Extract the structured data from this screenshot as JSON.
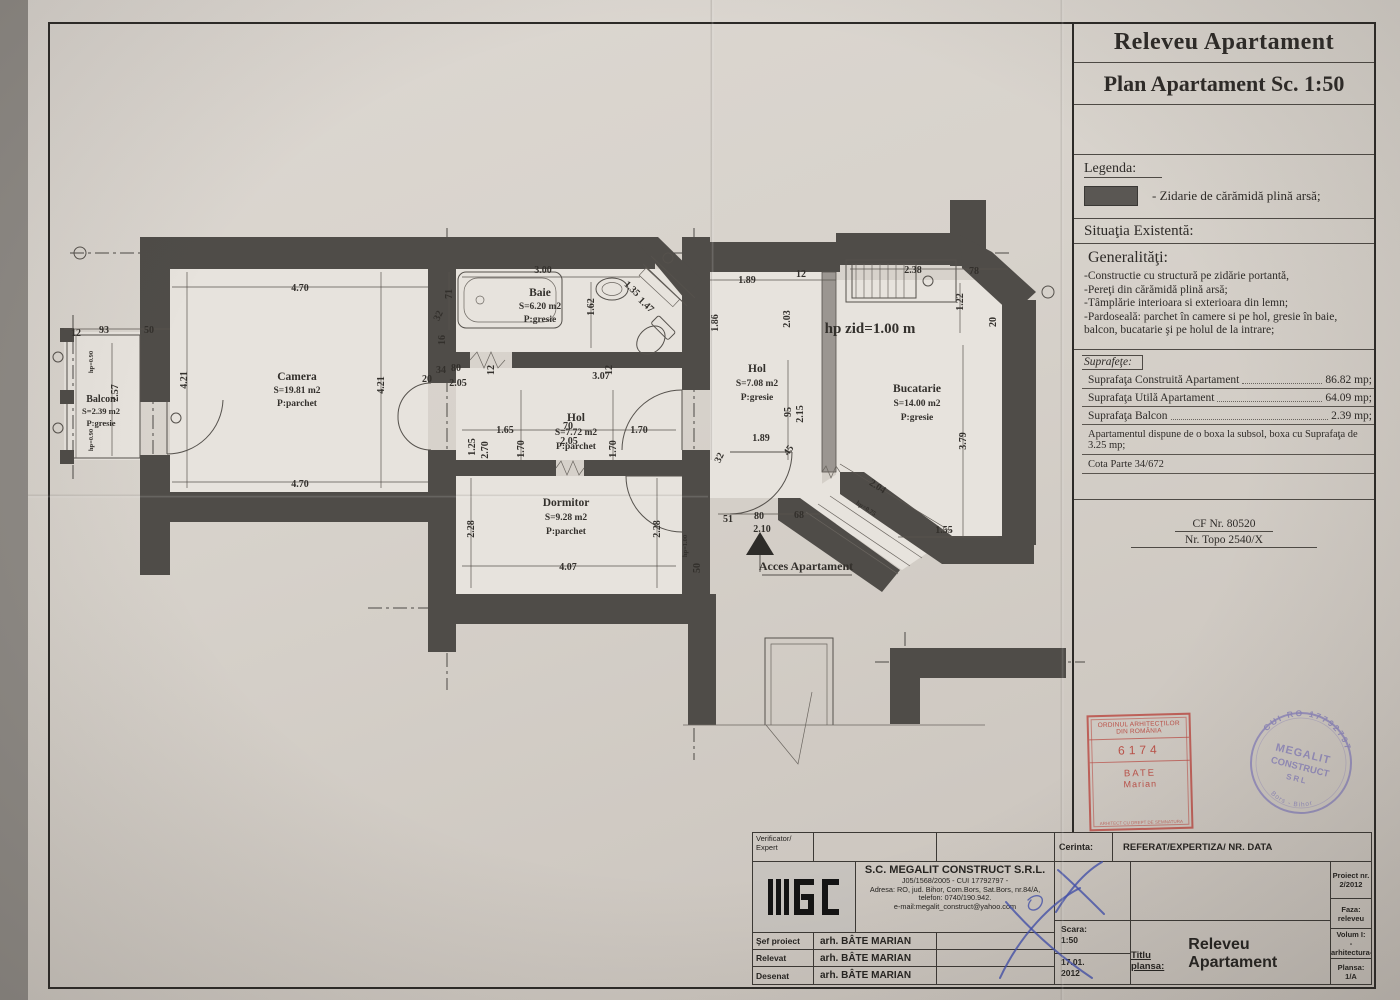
{
  "panel": {
    "title1": "Releveu Apartament",
    "title2": "Plan Apartament Sc. 1:50",
    "legend": {
      "label": "Legenda:",
      "item": "- Zidarie de cărămidă plină arsă;"
    },
    "situatia": "Situaţia Existentă:",
    "generalitati": {
      "heading": "Generalităţi:",
      "l1": "-Constructie cu structură pe zidărie portantă,",
      "l2": "-Pereţi din cărămidă plină arsă;",
      "l3": "-Tâmplărie interioara si exterioara din lemn;",
      "l4": "-Pardoseală: parchet în camere si pe hol, gresie în baie, balcon, bucatarie şi pe holul de la intrare;"
    },
    "suprafete": {
      "label": "Suprafeţe:",
      "rows": [
        {
          "name": "Suprafaţa Construită Apartament",
          "value": "86.82 mp;"
        },
        {
          "name": "Suprafaţa Utilă Apartament",
          "value": "64.09 mp;"
        },
        {
          "name": "Suprafaţa Balcon",
          "value": "2.39 mp;"
        }
      ],
      "boxa": "Apartamentul dispune de o boxa la subsol, boxa cu Suprafaţa de  3.25 mp;",
      "cota": "Cota Parte 34/672"
    },
    "cf": "CF Nr. 80520",
    "topo": "Nr. Topo 2540/X"
  },
  "plan": {
    "rooms": [
      {
        "name": "Camera",
        "area": "S=19.81 m2",
        "floor": "P:parchet"
      },
      {
        "name": "Baie",
        "area": "S=6.20 m2",
        "floor": "P:gresie"
      },
      {
        "name": "Hol",
        "area": "S=7.72 m2",
        "floor": "P:parchet"
      },
      {
        "name": "Dormitor",
        "area": "S=9.28 m2",
        "floor": "P:parchet"
      },
      {
        "name": "Hol",
        "area": "S=7.08 m2",
        "floor": "P:gresie"
      },
      {
        "name": "Bucatarie",
        "area": "S=14.00 m2",
        "floor": "P:gresie"
      },
      {
        "name": "Balcon",
        "area": "S=2.39 m2",
        "floor": "P:gresie"
      }
    ],
    "notes": {
      "hp_zid": "hp zid=1.00 m",
      "acces": "Acces Apartament"
    },
    "dims": [
      {
        "t": "4.70"
      },
      {
        "t": "4.70"
      },
      {
        "t": "4.21"
      },
      {
        "t": "4.21"
      },
      {
        "t": "2.57"
      },
      {
        "t": "12"
      },
      {
        "t": "93"
      },
      {
        "t": "50"
      },
      {
        "t": "71"
      },
      {
        "t": "3.00"
      },
      {
        "t": "1.62"
      },
      {
        "t": "1.35"
      },
      {
        "t": "1.47"
      },
      {
        "t": "32"
      },
      {
        "t": "16"
      },
      {
        "t": "20"
      },
      {
        "t": "34"
      },
      {
        "t": "80"
      },
      {
        "t": "2.05"
      },
      {
        "t": "12"
      },
      {
        "t": "12"
      },
      {
        "t": "3.07"
      },
      {
        "t": "1.70"
      },
      {
        "t": "1.70"
      },
      {
        "t": "1.65"
      },
      {
        "t": "70"
      },
      {
        "t": "2.05"
      },
      {
        "t": "1.70"
      },
      {
        "t": "1.25"
      },
      {
        "t": "2.70"
      },
      {
        "t": "1.89"
      },
      {
        "t": "12"
      },
      {
        "t": "1.86"
      },
      {
        "t": "2.03"
      },
      {
        "t": "2.38"
      },
      {
        "t": "78"
      },
      {
        "t": "1.22"
      },
      {
        "t": "20"
      },
      {
        "t": "95"
      },
      {
        "t": "2.15"
      },
      {
        "t": "1.89"
      },
      {
        "t": "3.79"
      },
      {
        "t": "32"
      },
      {
        "t": "45"
      },
      {
        "t": "51"
      },
      {
        "t": "80"
      },
      {
        "t": "2.10"
      },
      {
        "t": "68"
      },
      {
        "t": "2.04"
      },
      {
        "t": "hp=0.75"
      },
      {
        "t": "1.55"
      },
      {
        "t": "50"
      },
      {
        "t": "2.28"
      },
      {
        "t": "2.28"
      },
      {
        "t": "4.07"
      },
      {
        "t": "hp=1.00"
      },
      {
        "t": "hp=0.90"
      },
      {
        "t": "hp=0.90"
      }
    ]
  },
  "stamps": {
    "oar": {
      "l1": "ORDINUL ARHITECŢILOR",
      "l2": "DIN ROMÂNIA",
      "num": "6174",
      "n1": "BATE",
      "n2": "Marian",
      "foot": "ARHITECT CU DREPT DE SEMNATURA"
    },
    "round": {
      "arc_top": "CUI RO 17792797",
      "c1": "MEGALIT",
      "c2": "CONSTRUCT",
      "c3": "SRL",
      "arc_bottom": "Bors - Bihor"
    }
  },
  "titleblock": {
    "verificator": "Verificator/ Expert",
    "cerinta_label": "Cerinta:",
    "cerinta_value": "REFERAT/EXPERTIZA/ NR. DATA",
    "company": {
      "name": "S.C. MEGALIT CONSTRUCT S.R.L.",
      "reg": "J05/1568/2005 - CUI 17792797 -",
      "addr": "Adresa: RO, jud. Bihor, Com.Bors, Sat.Bors, nr.84/A,",
      "tel": "telefon: 0740/190.942.",
      "email": "e-mail:megalit_construct@yahoo.com"
    },
    "rows": [
      {
        "label": "Şef proiect",
        "name": "arh. BÂTE MARIAN"
      },
      {
        "label": "Relevat",
        "name": "arh. BÂTE MARIAN"
      },
      {
        "label": "Desenat",
        "name": "arh. BÂTE MARIAN"
      }
    ],
    "scara_label": "Scara:",
    "scara_value": "1:50",
    "date1": "17.01.",
    "date2": "2012",
    "titlu_label": "Titlu plansa:",
    "titlu_value": "Releveu Apartament",
    "right": [
      {
        "l1": "Proiect nr.",
        "l2": "2/2012"
      },
      {
        "l1": "Faza:",
        "l2": "releveu"
      },
      {
        "l1": "Volum I:",
        "l2": "-arhitectura-"
      },
      {
        "l1": "Plansa:",
        "l2": "1/A"
      }
    ]
  }
}
